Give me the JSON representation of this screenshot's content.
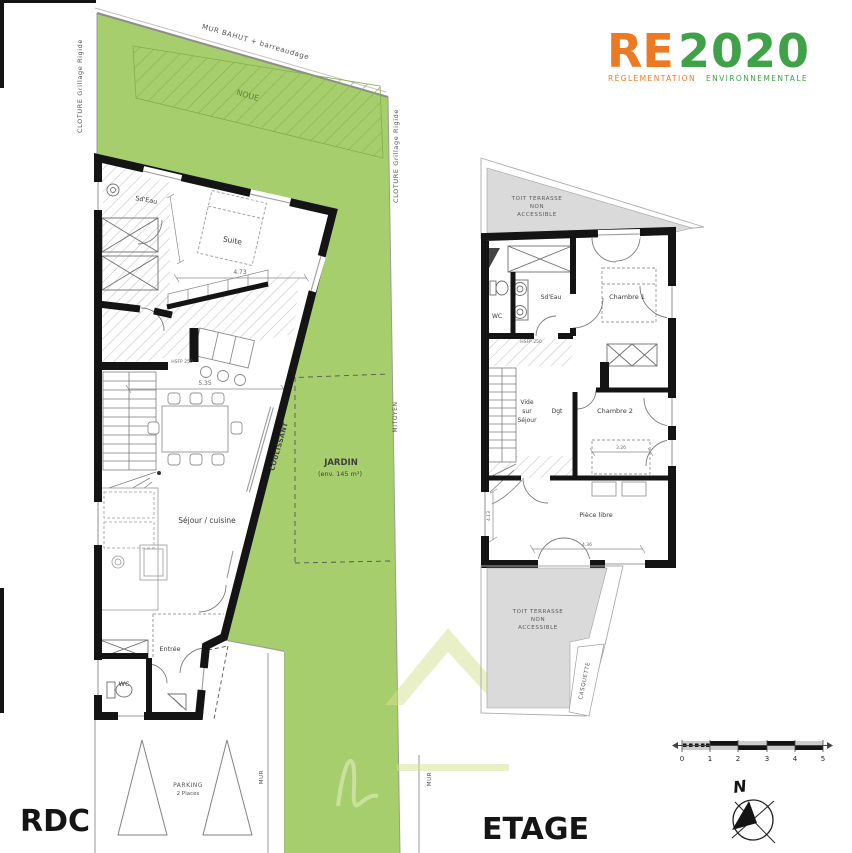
{
  "logo": {
    "re": "RE",
    "year": "2020",
    "subtitle_1": "RÉGLEMENTATION",
    "subtitle_2": "ENVIRONNEMENTALE"
  },
  "site": {
    "mur_bahut": "MUR BAHUT + barreaudage",
    "cloture": "CLOTURE Grillage Rigide",
    "noue": "NOUE",
    "jardin_title": "JARDIN",
    "jardin_area": "(env. 145 m²)",
    "mitoyen": "MITOYEN",
    "mur": "MUR",
    "coulissant": "COULISSANT"
  },
  "rdc": {
    "title": "RDC",
    "sdeau": "Sd'Eau",
    "suite": "Suite",
    "sejour": "Séjour / cuisine",
    "entree": "Entrée",
    "wc": "WC",
    "hsfp": "HSFP 250",
    "dim_suite": "4.73",
    "dim_sejour": "5.35",
    "parking_l1": "PARKING",
    "parking_l2": "2 Places"
  },
  "etage": {
    "title": "ETAGE",
    "toit_l1": "TOIT TERRASSE",
    "toit_l2": "NON",
    "toit_l3": "ACCESSIBLE",
    "wc": "WC",
    "sdeau": "Sd'Eau",
    "chambre1": "Chambre 1",
    "chambre2": "Chambre 2",
    "vide_l1": "Vide",
    "vide_l2": "sur",
    "vide_l3": "Séjour",
    "dgt": "Dgt",
    "piece_libre": "Pièce libre",
    "casquette": "CASQUETTE",
    "hsfp": "HSFP 250",
    "dim_chambre2": "3.26",
    "dim_piece_h": "4.13",
    "dim_piece_w": "4.36"
  },
  "compass": {
    "north": "N"
  },
  "scalebar": {
    "t0": "0",
    "t1": "1",
    "t2": "2",
    "t3": "3",
    "t4": "4",
    "t5": "5"
  }
}
